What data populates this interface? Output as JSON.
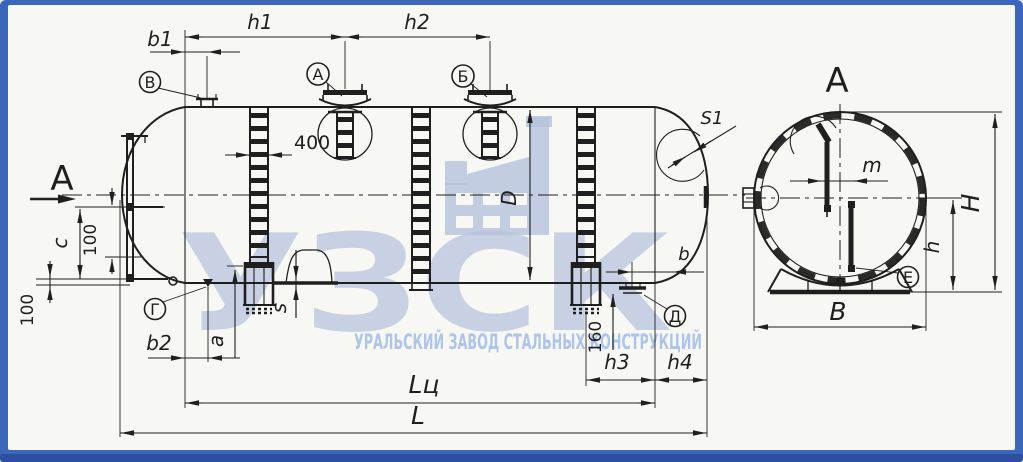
{
  "watermark": {
    "brand": "УЗСК",
    "subtitle": "УРАЛЬСКИЙ ЗАВОД СТАЛЬНЫХ КОНСТРУКЦИЙ"
  },
  "section": {
    "cut_arrow_label": "А",
    "view_title": "А"
  },
  "nozzle_labels": {
    "v": "В",
    "a": "А",
    "b": "Б",
    "g": "Г",
    "d": "Д",
    "e": "Е"
  },
  "dim_labels": {
    "h1": "h1",
    "h2": "h2",
    "b1": "b1",
    "n400": "400",
    "c": "c",
    "n100_side": "100",
    "n100_bottom": "100",
    "b2": "b2",
    "a": "a",
    "s": "s",
    "s1": "S1",
    "diameter": "D",
    "b": "b",
    "n160": "160",
    "h3": "h3",
    "h4": "h4",
    "lc": "Lц",
    "l": "L",
    "m": "m",
    "height_total": "H",
    "h_axis": "h",
    "width_b": "В"
  },
  "colors": {
    "frame": "#3c66bb",
    "frame_dark": "#2d4f9f",
    "paper": "#f7f7f4",
    "ink": "#1f1f1f",
    "watermark": "#b4c2dc",
    "watermark_text": "#a6c0e8"
  }
}
